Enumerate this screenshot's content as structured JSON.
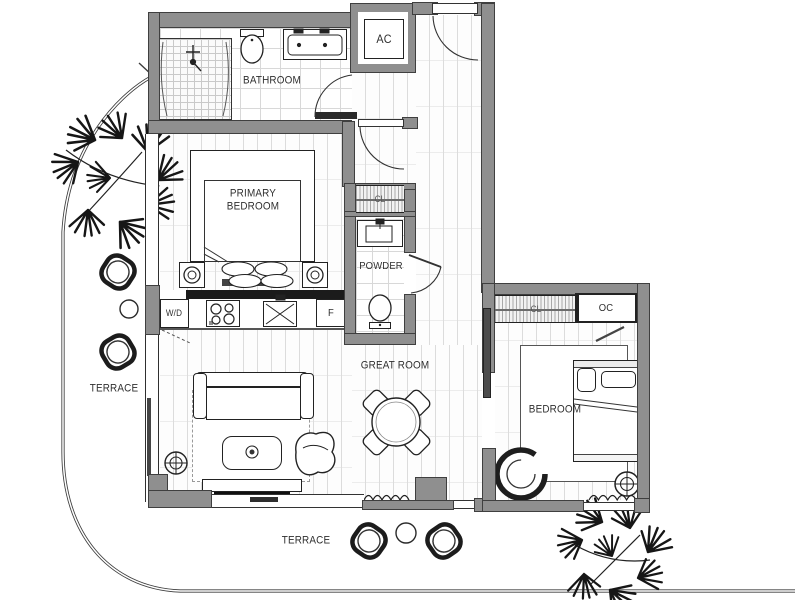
{
  "floor_plan": {
    "rooms": {
      "bathroom": {
        "label": "BATHROOM"
      },
      "primary_bedroom": {
        "label": "PRIMARY\nBEDROOM"
      },
      "powder_room": {
        "label": "POWDER"
      },
      "great_room": {
        "label": "GREAT ROOM"
      },
      "bedroom": {
        "label": "BEDROOM"
      }
    },
    "terraces": {
      "left": {
        "label": "TERRACE"
      },
      "bottom": {
        "label": "TERRACE"
      }
    },
    "closets": {
      "ac_closet": {
        "label": "AC"
      },
      "owner_closet": {
        "label": "OC"
      },
      "primary_closet": {
        "label": "CL"
      },
      "bedroom_closet": {
        "label": "CL"
      }
    },
    "kitchen": {
      "washer_dryer": {
        "label": "W/D"
      },
      "refrigerator": {
        "label": "F"
      }
    },
    "colors": {
      "wall": "#8f8f8f",
      "wall_edge": "#3f3f3f",
      "line": "#222222",
      "floor_joint": "#dcdcdc"
    }
  }
}
